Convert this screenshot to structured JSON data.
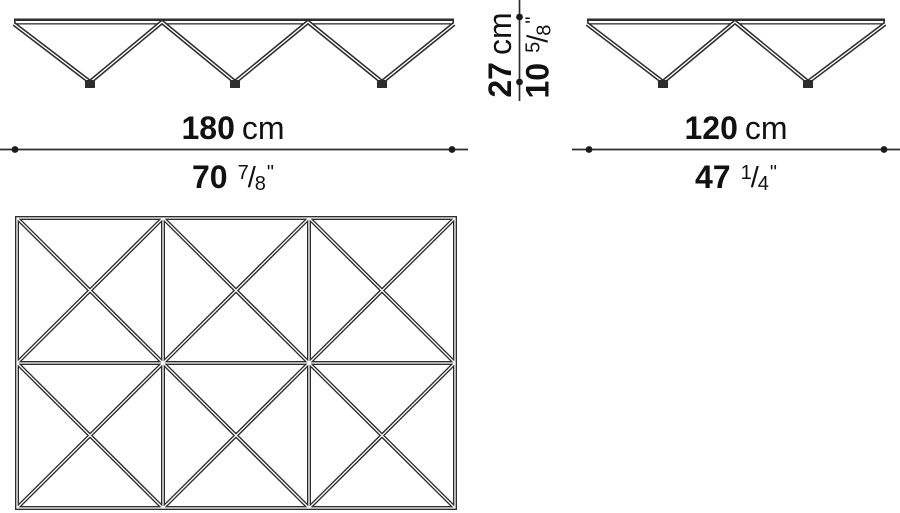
{
  "figure": {
    "front_width": {
      "cm_value": "180",
      "cm_unit": "cm",
      "inch_whole": "70",
      "inch_numerator": "7",
      "inch_slash": "/",
      "inch_denominator": "8",
      "inch_mark": "\""
    },
    "side_width": {
      "cm_value": "120",
      "cm_unit": "cm",
      "inch_whole": "47",
      "inch_numerator": "1",
      "inch_slash": "/",
      "inch_denominator": "4",
      "inch_mark": "\""
    },
    "height": {
      "cm_value": "27",
      "cm_unit": "cm",
      "inch_whole": "10",
      "inch_numerator": "5",
      "inch_slash": "/",
      "inch_denominator": "8",
      "inch_mark": "\""
    },
    "colors": {
      "line": "#2d2d2d",
      "text": "#111111",
      "background": "#ffffff"
    }
  }
}
